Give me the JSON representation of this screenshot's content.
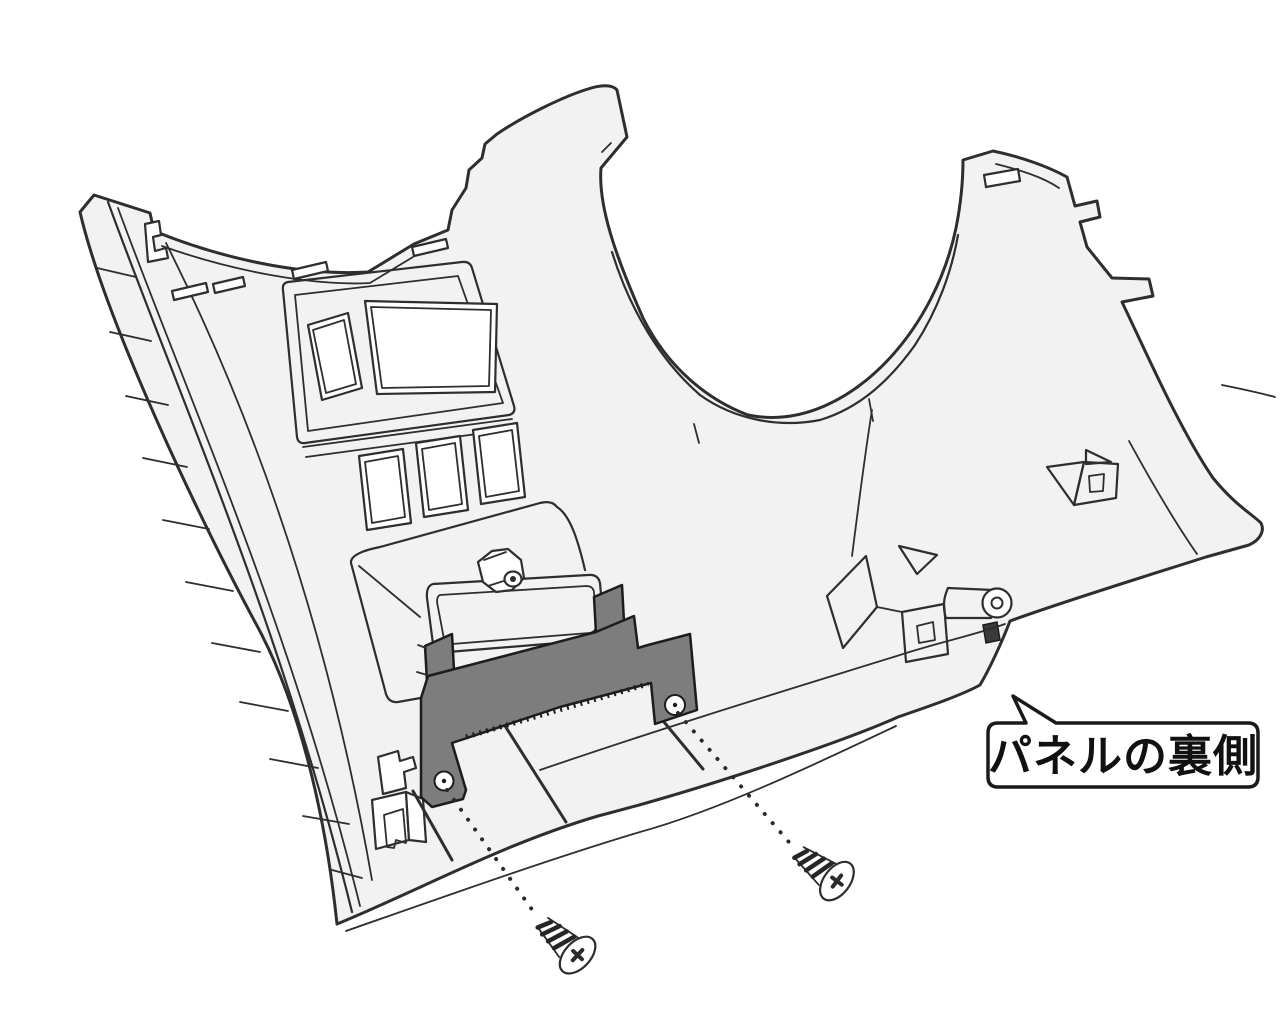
{
  "callout": {
    "label": "パネルの裏側"
  },
  "colors": {
    "background": "#ffffff",
    "panel_fill": "#f2f2f2",
    "cutout_fill": "#ffffff",
    "bracket_fill": "#7d7d7d",
    "outline": "#2e2e2e",
    "callout_border": "#1a1a1a",
    "callout_text": "#111111"
  },
  "parts": {
    "panel": "instrument-panel-back-side",
    "bracket": "mounting-bracket",
    "screw_left": "tapping-screw",
    "screw_right": "tapping-screw",
    "stud": "locator-stud",
    "clips": [
      "box-clip",
      "funnel-clip",
      "roller-clip"
    ]
  }
}
